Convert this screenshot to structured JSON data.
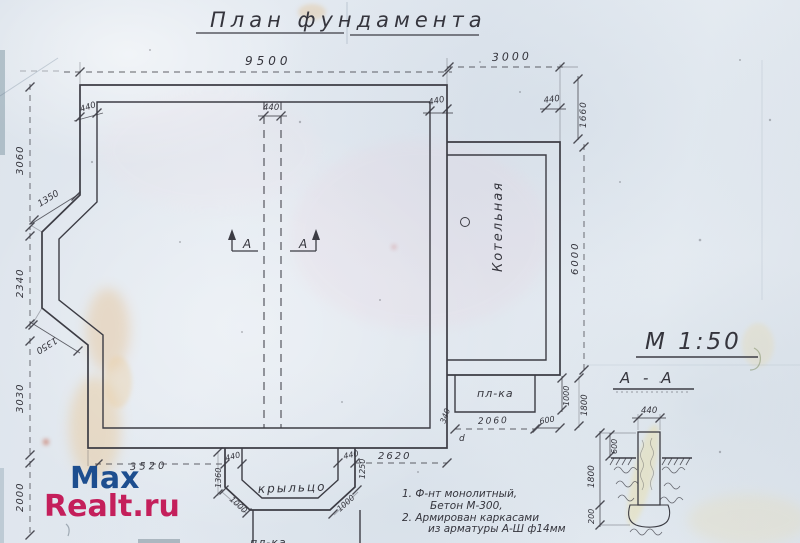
{
  "page": {
    "title": "План фундамента",
    "scale": "М 1:50"
  },
  "watermark": {
    "line1": "Max",
    "line2": "Realt.ru",
    "color_line1": "#1d4e8f",
    "color_line2": "#c41f5b"
  },
  "plan": {
    "room_label": "Котельная",
    "porch_label": "крыльцо",
    "platform_label": "пл-ка",
    "porch_platform_label": "пл-ка",
    "point_label": "d",
    "section_marker": "А"
  },
  "section": {
    "title": "А - А",
    "width": "440",
    "above_ground": "600",
    "depth": "1800",
    "footing": "200"
  },
  "notes": {
    "line1": "1.  Ф-нт  монолитный,",
    "line2": "Бетон  М-300,",
    "line3": "2.  Армирован  каркасами",
    "line4": "из  арматуры  А-Ш  ф14мм"
  },
  "dims": {
    "top_main": "9500",
    "top_ext": "3000",
    "wall_tl": "440",
    "wall_mid": "440",
    "wall_tr": "440",
    "wall_ext": "440",
    "ext_offset": "1660",
    "ext_height": "6000",
    "left_top": "3060",
    "bay_top": "1350",
    "bay_side": "2340",
    "bay_bottom": "1350",
    "left_bottom": "3030",
    "left_porch": "2000",
    "bot_left": "3520",
    "porch_wall_left": "440",
    "porch_depth_left": "1360",
    "chamfer_left": "1000",
    "chamfer_right": "1000",
    "porch_wall_right": "440",
    "porch_depth_right": "1250",
    "bot_right": "2620",
    "plat_offset": "340",
    "plat_width": "2060",
    "plat_right": "600",
    "plat_height": "1000",
    "plat_depth": "1800"
  },
  "colors": {
    "ink": "#3c3c44",
    "paper": "#e1e7ee"
  }
}
